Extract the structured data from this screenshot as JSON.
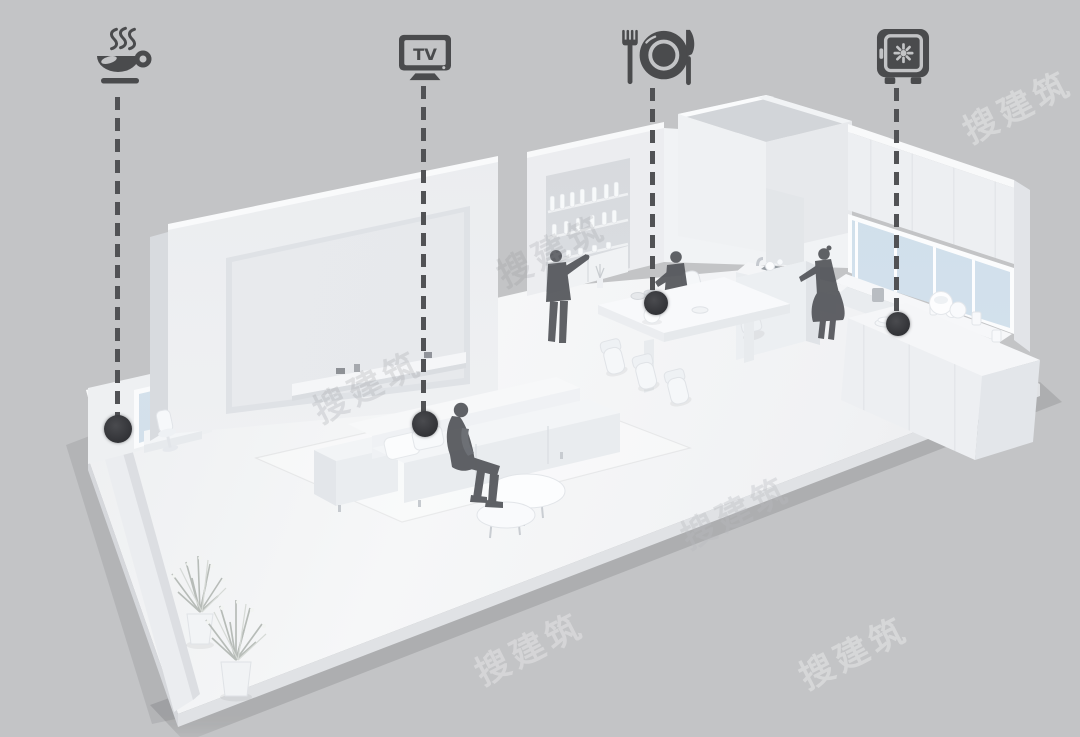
{
  "scene": {
    "description": "monochrome 3D axonometric cutaway render of an apartment with four zone-marker icons connected by dashed leader lines",
    "background_color": "#c3c4c6",
    "model_color": "#f2f3f5",
    "annotation_color": "#4a4b4d"
  },
  "watermark": {
    "text": "搜建筑"
  },
  "annotations": {
    "coffee": {
      "icon": "coffee-cup-icon"
    },
    "tv": {
      "icon": "tv-icon",
      "label": "TV"
    },
    "dining": {
      "icon": "fork-plate-knife-icon"
    },
    "safe": {
      "icon": "safe-icon"
    }
  }
}
